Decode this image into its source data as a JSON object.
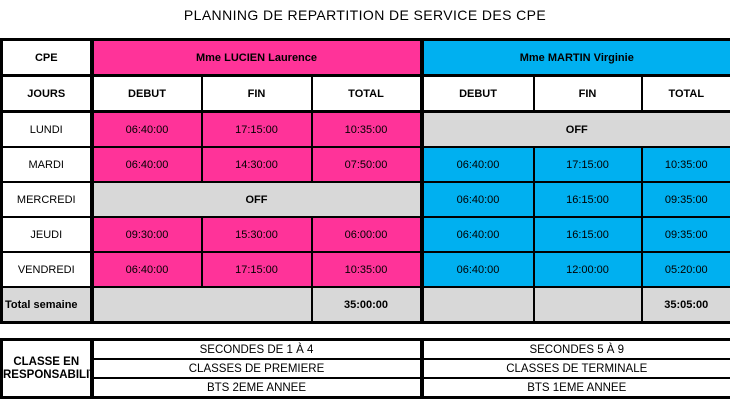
{
  "title": "PLANNING DE REPARTITION DE SERVICE DES CPE",
  "colors": {
    "pink": "#FF3399",
    "cyan": "#00B0F0",
    "gray": "#D8D8D8",
    "border": "#000000"
  },
  "planning": {
    "corner_label": "CPE",
    "days_label": "JOURS",
    "cpe": [
      {
        "name": "Mme LUCIEN Laurence"
      },
      {
        "name": "Mme MARTIN Virginie"
      }
    ],
    "subheaders": {
      "debut": "DEBUT",
      "fin": "FIN",
      "total": "TOTAL"
    },
    "off_label": "OFF",
    "rows": [
      {
        "day": "LUNDI",
        "lucien": [
          "06:40:00",
          "17:15:00",
          "10:35:00"
        ],
        "martin": "OFF"
      },
      {
        "day": "MARDI",
        "lucien": [
          "06:40:00",
          "14:30:00",
          "07:50:00"
        ],
        "martin": [
          "06:40:00",
          "17:15:00",
          "10:35:00"
        ]
      },
      {
        "day": "MERCREDI",
        "lucien": "OFF",
        "martin": [
          "06:40:00",
          "16:15:00",
          "09:35:00"
        ]
      },
      {
        "day": "JEUDI",
        "lucien": [
          "09:30:00",
          "15:30:00",
          "06:00:00"
        ],
        "martin": [
          "06:40:00",
          "16:15:00",
          "09:35:00"
        ]
      },
      {
        "day": "VENDREDI",
        "lucien": [
          "06:40:00",
          "17:15:00",
          "10:35:00"
        ],
        "martin": [
          "06:40:00",
          "12:00:00",
          "05:20:00"
        ]
      }
    ],
    "total_row": {
      "label": "Total semaine",
      "lucien_total": "35:00:00",
      "martin_total": "35:05:00"
    }
  },
  "classes": {
    "label_lines": [
      "CLASSE EN",
      "RESPONSABILITE"
    ],
    "lucien": [
      "SECONDES DE 1 À 4",
      "CLASSES DE PREMIERE",
      "BTS 2EME ANNEE"
    ],
    "martin": [
      "SECONDES 5 À 9",
      "CLASSES DE TERMINALE",
      "BTS 1EME ANNEE"
    ]
  }
}
